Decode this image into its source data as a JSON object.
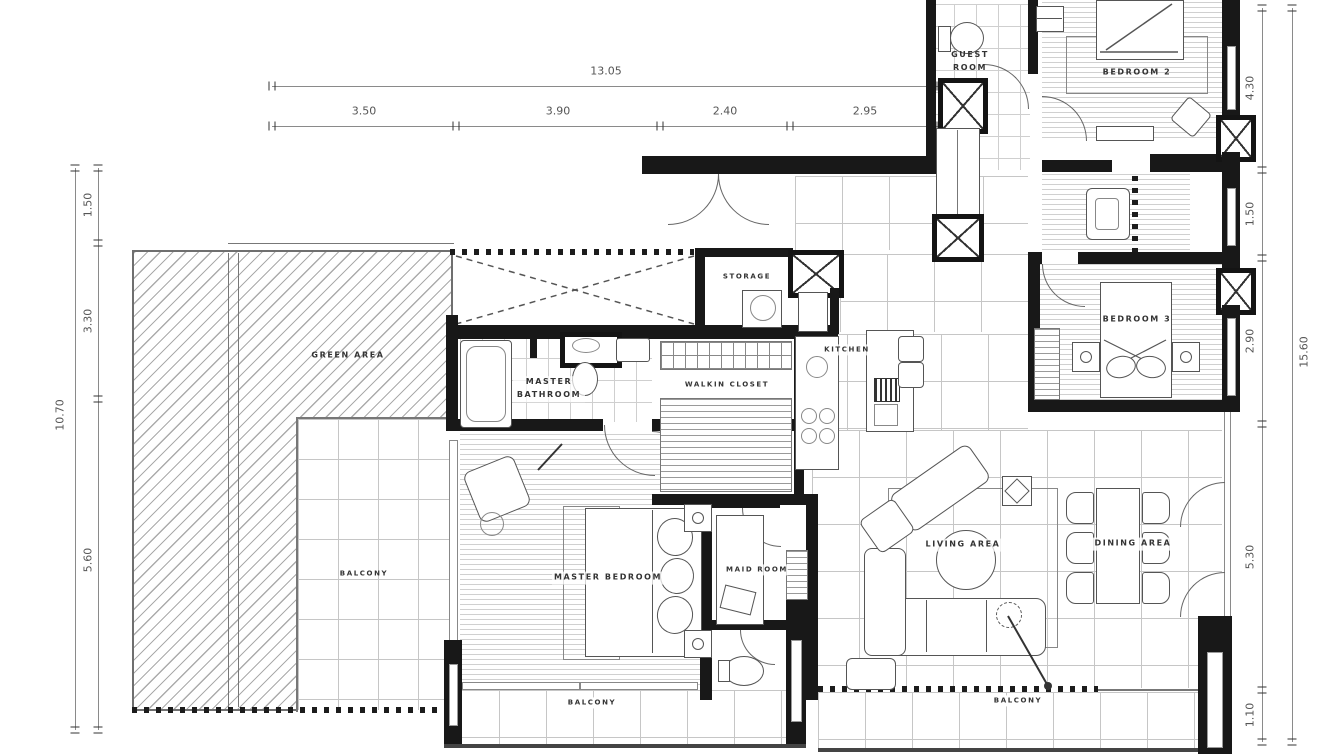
{
  "plan_title": "apartment unit floor plan",
  "dimensions": {
    "top": {
      "total": "13.05",
      "segments": [
        "3.50",
        "3.90",
        "2.40",
        "2.95"
      ]
    },
    "left": {
      "total": "10.70",
      "segments": [
        "1.50",
        "3.30",
        "5.60"
      ]
    },
    "right": {
      "total": "15.60",
      "segments": [
        "4.30",
        "1.50",
        "2.90",
        "5.30",
        "1.10"
      ]
    }
  },
  "rooms": {
    "green_area": "GREEN AREA",
    "balcony_left": "BALCONY",
    "master_bedroom": "MASTER BEDROOM",
    "master_bathroom": "MASTER BATHROOM",
    "walkin_closet": "WALKIN CLOSET",
    "storage": "STORAGE",
    "kitchen": "KITCHEN",
    "guest_room": "GUEST ROOM",
    "bedroom2": "BEDROOM 2",
    "bedroom3": "BEDROOM 3",
    "living_area": "LIVING AREA",
    "dining_area": "DINING AREA",
    "maid_room": "MAID ROOM",
    "balcony_bottom": "BALCONY",
    "balcony_right": "BALCONY"
  },
  "colors": {
    "wall": "#181818",
    "line": "#8a8a8a",
    "label_text": "#333333",
    "dim_text": "#555555"
  }
}
